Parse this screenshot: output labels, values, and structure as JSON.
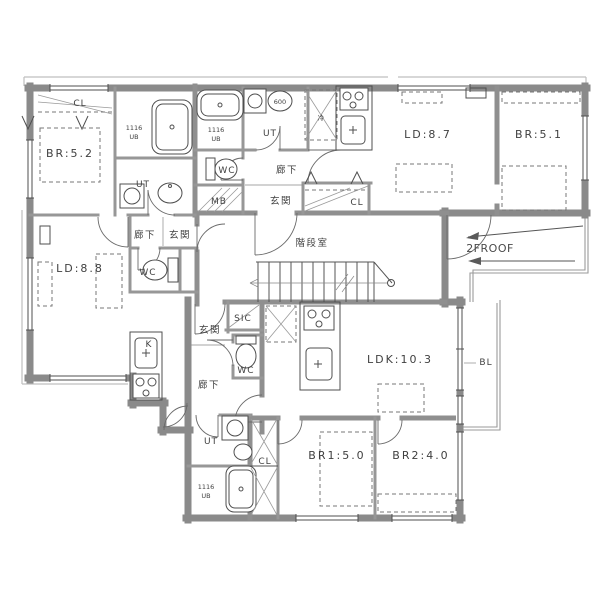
{
  "drawing_type": "2F apartment floor plan",
  "colors": {
    "wall": "#8a8a8a",
    "line": "#4f4f4f",
    "text": "#404040",
    "background": "#ffffff"
  },
  "units": {
    "west_1ldk": {
      "bedroom": "BR:5.2",
      "living_dining": "LD:8.8",
      "kitchen": "K",
      "utility": "UT",
      "toilet": "WC",
      "closet": "CL",
      "entrance": "玄関",
      "hallway": "廊下",
      "bath_size": "1116",
      "bath": "UB"
    },
    "north_1ldk": {
      "living_dining": "LD:8.7",
      "bedroom": "BR:5.1",
      "utility": "UT",
      "toilet": "WC",
      "closet": "CL",
      "entrance": "玄関",
      "hallway": "廊下",
      "bath_size": "1116",
      "bath": "UB",
      "meter_box": "MB",
      "refrigerator": "冷",
      "basin_width": "600"
    },
    "south_2ldk": {
      "ldk": "LDK:10.3",
      "bedroom1": "BR1:5.0",
      "bedroom2": "BR2:4.0",
      "utility": "UT",
      "toilet": "WC",
      "closet": "CL",
      "shoe_closet": "SIC",
      "entrance": "玄関",
      "hallway": "廊下",
      "bath_size": "1116",
      "bath": "UB",
      "balcony": "BL"
    },
    "common": {
      "stairwell": "階段室",
      "roof": "2FROOF"
    }
  }
}
